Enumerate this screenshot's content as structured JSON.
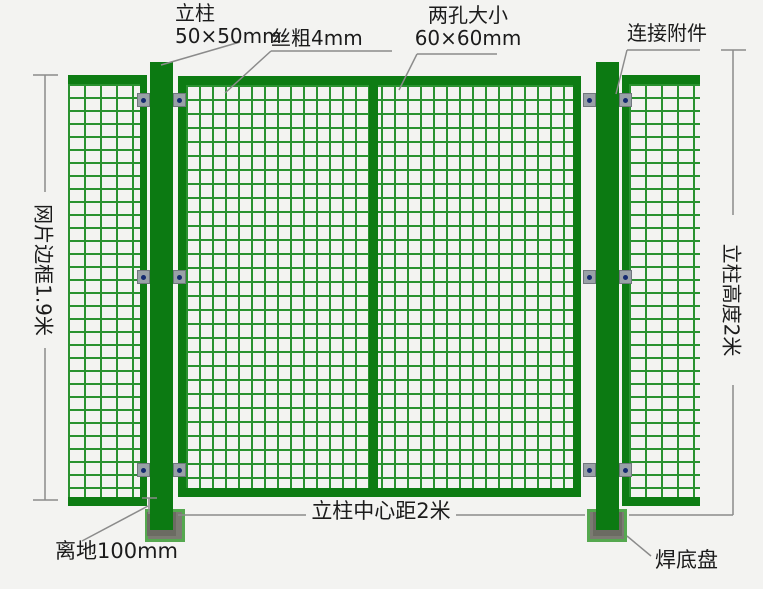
{
  "annotations": {
    "post_spec_line1": "立柱",
    "post_spec_line2": "50×50mm",
    "wire_thickness": "丝粗4mm",
    "hole_size_line1": "两孔大小",
    "hole_size_line2": "60×60mm",
    "connector": "连接附件",
    "mesh_frame_height": "网片边框1.9米",
    "post_height": "立柱高度2米",
    "ground_clearance": "离地100mm",
    "post_center_distance": "立柱中心距2米",
    "base_plate": "焊底盘"
  },
  "palette": {
    "background": "#f3f3f1",
    "frame_green": "#0d7c13",
    "mesh_green": "#2a9230",
    "post_green": "#0c7a12",
    "base_gray": "#7b7b72",
    "base_border_green": "#55a84f",
    "clamp_gray": "#99a1a7",
    "bolt_navy": "#152b70",
    "dimension_line_gray": "#8b8b8b",
    "text_color": "#1b1b1b"
  }
}
